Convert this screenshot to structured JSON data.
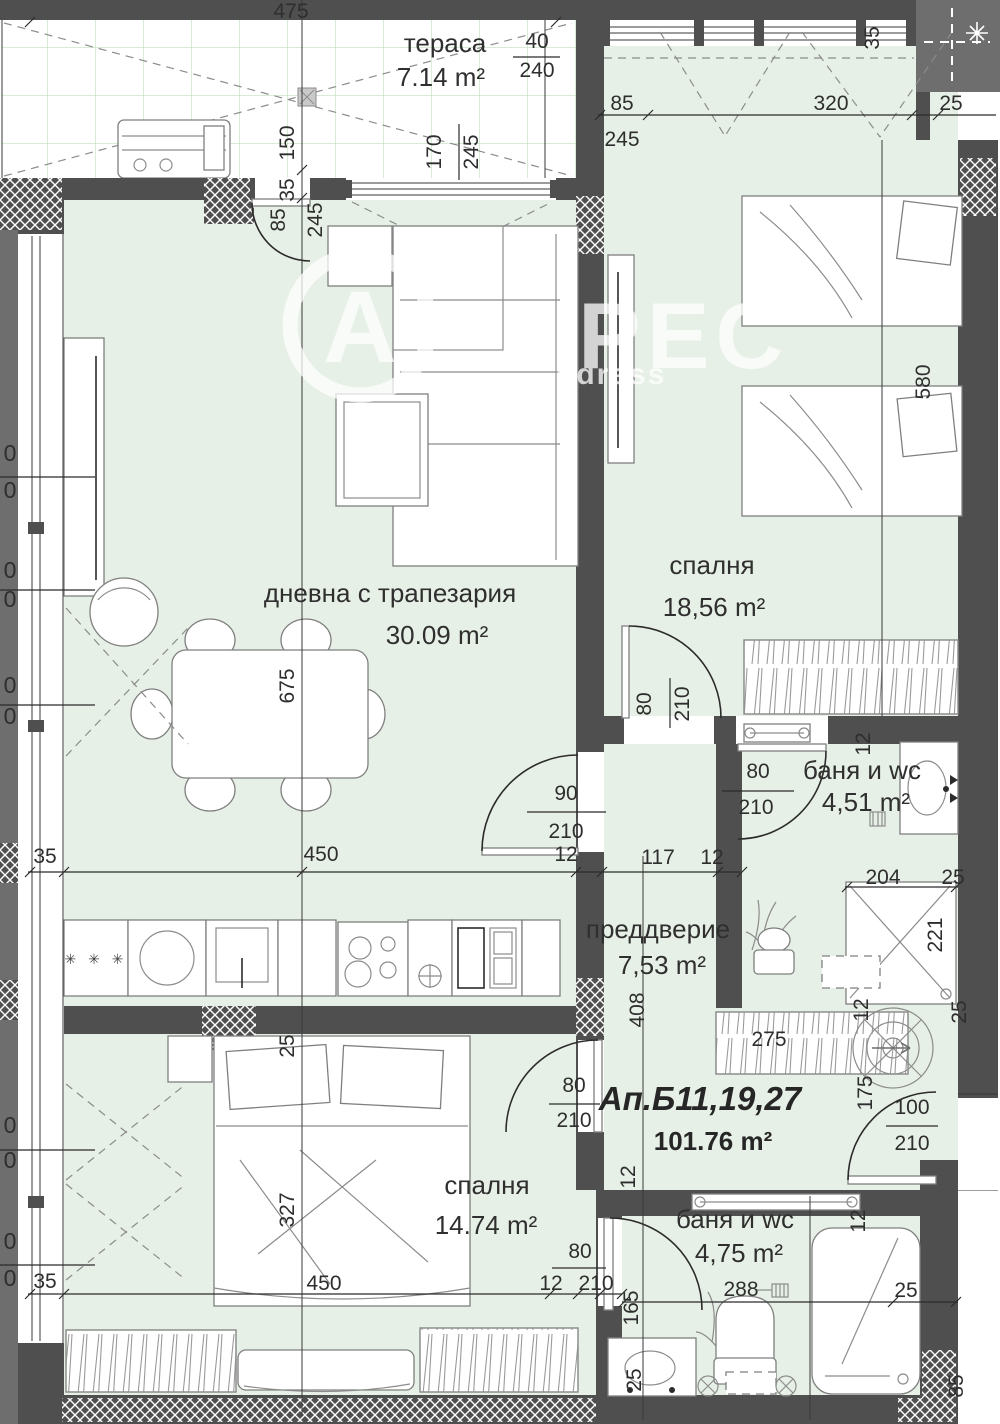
{
  "watermark": {
    "circle_letter": "А",
    "brand": "РЕС",
    "subtext": "ddress"
  },
  "apartment": {
    "label": "Ап.Б11,19,27",
    "area": "101.76 m²"
  },
  "rooms": [
    {
      "key": "terrace",
      "name": "тераса",
      "area": "7.14 m²"
    },
    {
      "key": "living",
      "name": "дневна с трапезария",
      "area": "30.09 m²"
    },
    {
      "key": "bedroom-1",
      "name": "спалня",
      "area": "18,56 m²"
    },
    {
      "key": "bath-1",
      "name": "баня и wc",
      "area": "4,51 m²"
    },
    {
      "key": "hall",
      "name": "преддверие",
      "area": "7,53 m²"
    },
    {
      "key": "bedroom-2",
      "name": "спалня",
      "area": "14.74 m²"
    },
    {
      "key": "bath-2",
      "name": "баня и wc",
      "area": "4,75 m²"
    }
  ],
  "kitchen_symbol": "✳ ✳ ✳",
  "colors": {
    "wall": "#4f4f4f",
    "neighbor": "#6e6e6e",
    "room_fill": "#e7f0e6",
    "terrace_grid": "#bfdfbf"
  },
  "dimensions": [
    {
      "t": "475",
      "x": 291,
      "y": 18
    },
    {
      "t": "40",
      "x": 537,
      "y": 48
    },
    {
      "t": "240",
      "x": 537,
      "y": 77
    },
    {
      "t": "85",
      "x": 622,
      "y": 110
    },
    {
      "t": "245",
      "x": 622,
      "y": 146
    },
    {
      "t": "320",
      "x": 831,
      "y": 110
    },
    {
      "t": "25",
      "x": 951,
      "y": 110
    },
    {
      "t": "35",
      "x": 879,
      "y": 38,
      "r": 1
    },
    {
      "t": "150",
      "x": 294,
      "y": 143,
      "r": 1
    },
    {
      "t": "35",
      "x": 294,
      "y": 190,
      "r": 1
    },
    {
      "t": "170",
      "x": 441,
      "y": 152,
      "r": 1
    },
    {
      "t": "245",
      "x": 478,
      "y": 152,
      "r": 1
    },
    {
      "t": "85",
      "x": 285,
      "y": 220,
      "r": 1
    },
    {
      "t": "245",
      "x": 322,
      "y": 220,
      "r": 1
    },
    {
      "t": "580",
      "x": 930,
      "y": 382,
      "r": 1
    },
    {
      "t": "675",
      "x": 294,
      "y": 686,
      "r": 1
    },
    {
      "t": "80",
      "x": 651,
      "y": 704,
      "r": 1
    },
    {
      "t": "210",
      "x": 689,
      "y": 704,
      "r": 1
    },
    {
      "t": "90",
      "x": 566,
      "y": 800
    },
    {
      "t": "210",
      "x": 566,
      "y": 838
    },
    {
      "t": "80",
      "x": 758,
      "y": 778
    },
    {
      "t": "210",
      "x": 756,
      "y": 814
    },
    {
      "t": "12",
      "x": 870,
      "y": 744,
      "r": 1
    },
    {
      "t": "35",
      "x": 45,
      "y": 863
    },
    {
      "t": "450",
      "x": 321,
      "y": 861
    },
    {
      "t": "12",
      "x": 566,
      "y": 861
    },
    {
      "t": "117",
      "x": 658,
      "y": 864
    },
    {
      "t": "12",
      "x": 712,
      "y": 864
    },
    {
      "t": "204",
      "x": 883,
      "y": 884
    },
    {
      "t": "25",
      "x": 953,
      "y": 884
    },
    {
      "t": "221",
      "x": 942,
      "y": 935,
      "r": 1
    },
    {
      "t": "408",
      "x": 644,
      "y": 1010,
      "r": 1
    },
    {
      "t": "275",
      "x": 769,
      "y": 1046
    },
    {
      "t": "12",
      "x": 868,
      "y": 1010,
      "r": 1
    },
    {
      "t": "25",
      "x": 966,
      "y": 1012,
      "r": 1
    },
    {
      "t": "175",
      "x": 872,
      "y": 1093,
      "r": 1
    },
    {
      "t": "100",
      "x": 912,
      "y": 1114
    },
    {
      "t": "210",
      "x": 912,
      "y": 1150
    },
    {
      "t": "80",
      "x": 574,
      "y": 1092
    },
    {
      "t": "210",
      "x": 574,
      "y": 1127
    },
    {
      "t": "12",
      "x": 635,
      "y": 1177,
      "r": 1
    },
    {
      "t": "25",
      "x": 294,
      "y": 1046,
      "r": 1
    },
    {
      "t": "327",
      "x": 294,
      "y": 1210,
      "r": 1
    },
    {
      "t": "12",
      "x": 865,
      "y": 1221,
      "r": 1
    },
    {
      "t": "80",
      "x": 580,
      "y": 1258
    },
    {
      "t": "210",
      "x": 596,
      "y": 1290
    },
    {
      "t": "12",
      "x": 551,
      "y": 1290
    },
    {
      "t": "165",
      "x": 638,
      "y": 1308,
      "r": 1
    },
    {
      "t": "288",
      "x": 741,
      "y": 1296
    },
    {
      "t": "25",
      "x": 906,
      "y": 1297
    },
    {
      "t": "35",
      "x": 45,
      "y": 1288
    },
    {
      "t": "450",
      "x": 324,
      "y": 1290
    },
    {
      "t": "25",
      "x": 641,
      "y": 1380,
      "r": 1
    },
    {
      "t": "85",
      "x": 963,
      "y": 1386,
      "r": 1
    },
    {
      "t": "0",
      "x": 10,
      "y": 461
    },
    {
      "t": "0",
      "x": 10,
      "y": 498
    },
    {
      "t": "0",
      "x": 10,
      "y": 578
    },
    {
      "t": "0",
      "x": 10,
      "y": 607
    },
    {
      "t": "0",
      "x": 10,
      "y": 693
    },
    {
      "t": "0",
      "x": 10,
      "y": 724
    },
    {
      "t": "0",
      "x": 10,
      "y": 1133
    },
    {
      "t": "0",
      "x": 10,
      "y": 1168
    },
    {
      "t": "0",
      "x": 10,
      "y": 1249
    },
    {
      "t": "0",
      "x": 10,
      "y": 1286
    }
  ]
}
